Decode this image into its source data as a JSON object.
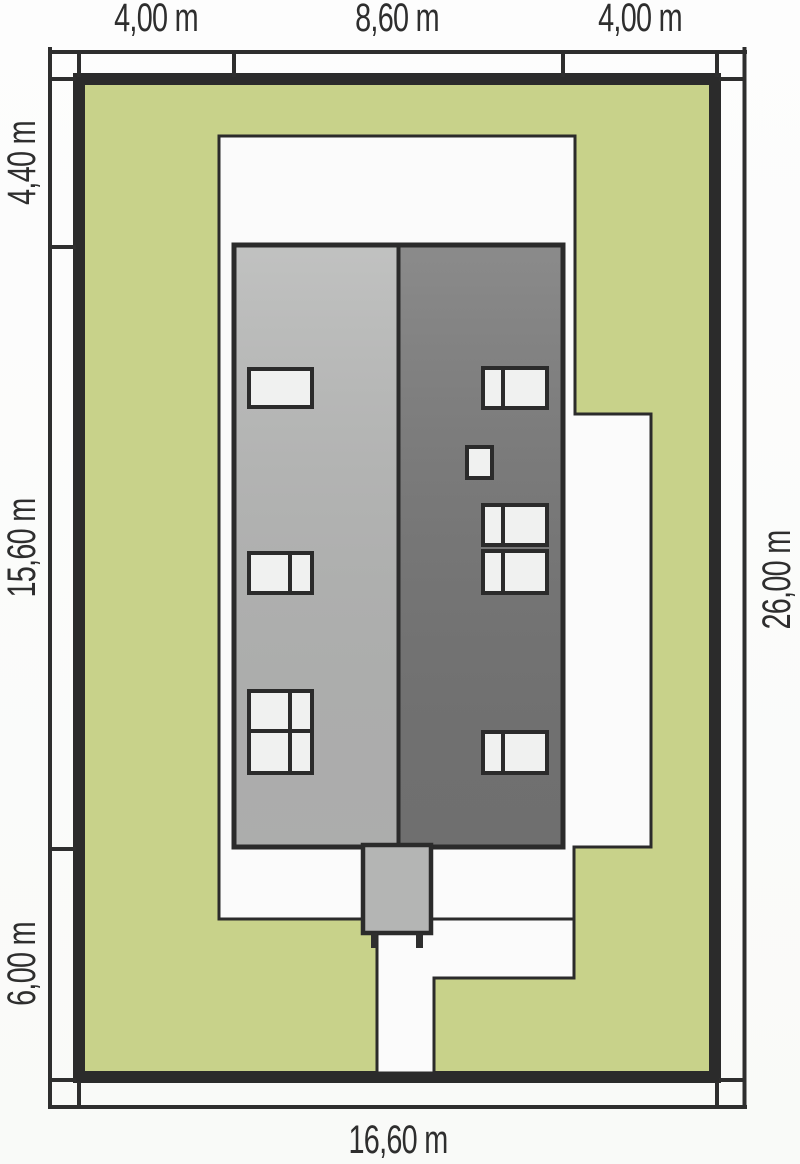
{
  "site_plan": {
    "title": "house plot site plan",
    "dimensions": {
      "top": [
        {
          "label": "4,00 m"
        },
        {
          "label": "8,60 m"
        },
        {
          "label": "4,00 m"
        }
      ],
      "left": [
        {
          "label": "4,40 m"
        },
        {
          "label": "15,60 m"
        },
        {
          "label": "6,00 m"
        }
      ],
      "right": [
        {
          "label": "26,00 m"
        }
      ],
      "bottom": [
        {
          "label": "16,60 m"
        }
      ]
    },
    "colors": {
      "lawn": "#c8d28a",
      "roof_left": "#b5b6b5",
      "roof_right": "#757575",
      "chimney": "#b4b5b4",
      "paving": "#fbfbfb",
      "window": "#f0f1f0",
      "outline": "#2b2b2b",
      "ink": "#2e2e2e"
    }
  }
}
